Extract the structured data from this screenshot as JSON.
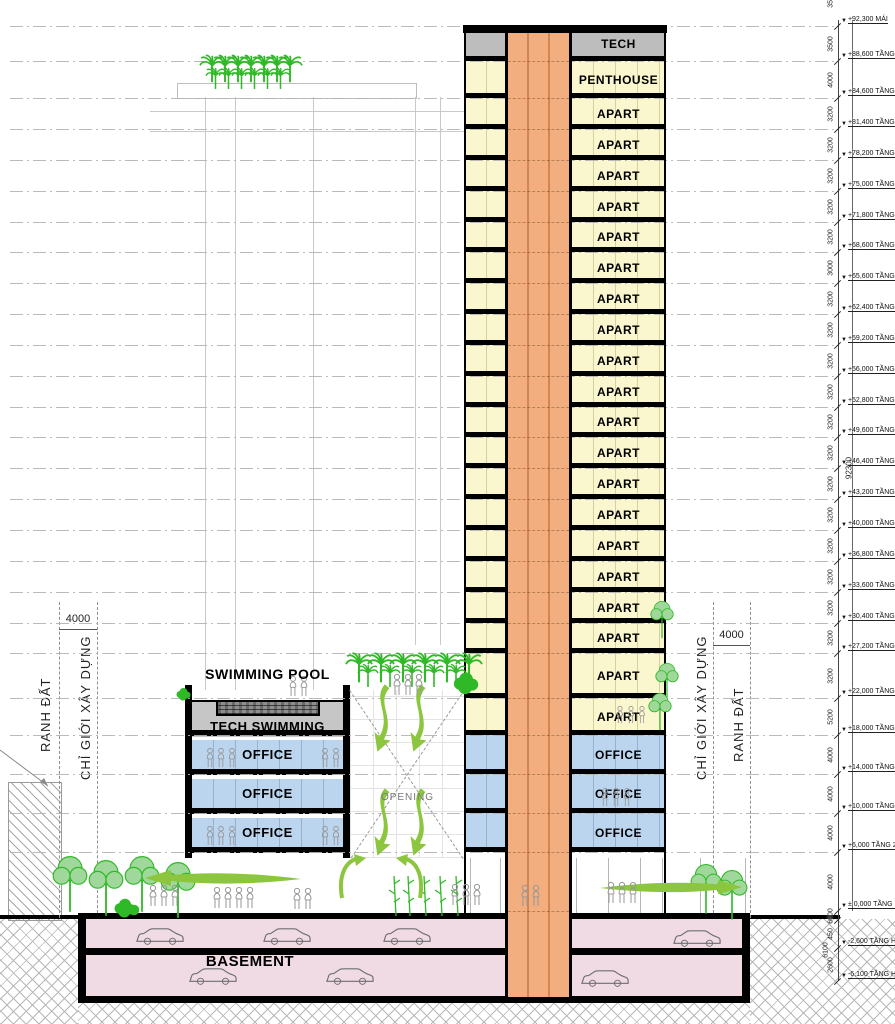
{
  "colors": {
    "slab": "#000000",
    "apart_fill": "#FAF7CE",
    "office_fill": "#BCD5EE",
    "core_fill": "#F2AE7E",
    "tech_gray": "#BDBDBD",
    "basement_fill": "#F0DBE4",
    "tree_green": "#2FB927",
    "swoosh_green": "#8CC63E"
  },
  "levels": {
    "ticks": [
      26,
      61,
      98,
      129,
      160,
      191,
      222,
      252,
      283,
      314,
      345,
      376,
      407,
      437,
      468,
      499,
      530,
      561,
      592,
      623,
      653,
      698,
      735,
      774,
      813,
      852,
      911,
      920,
      948,
      981
    ],
    "dims": [
      "3500",
      "4000",
      "3200",
      "3200",
      "3200",
      "3200",
      "3200",
      "3000",
      "3200",
      "3200",
      "3200",
      "3200",
      "3200",
      "3200",
      "3200",
      "3200",
      "3200",
      "3200",
      "3200",
      "3200",
      "3200",
      "5200",
      "4000",
      "4000",
      "4000",
      "4000",
      "6000",
      "450",
      "2600",
      "3500"
    ],
    "total_dim": "92300",
    "basement_total_dim": "6100",
    "markers": [
      {
        "label": "+92,300 MÁI",
        "tick": 0
      },
      {
        "label": "+88,600 TẦNG KỸ 1",
        "tick": 1
      },
      {
        "label": "+84,600 TẦNG 25",
        "tick": 2
      },
      {
        "label": "+81,400 TẦNG 24",
        "tick": 3
      },
      {
        "label": "+78,200 TẦNG 23",
        "tick": 4
      },
      {
        "label": "+75,000 TẦNG 22",
        "tick": 5
      },
      {
        "label": "+71,800 TẦNG 21",
        "tick": 6
      },
      {
        "label": "+68,600 TẦNG 20",
        "tick": 7
      },
      {
        "label": "+65,600 TẦNG 19",
        "tick": 8
      },
      {
        "label": "+62,400 TẦNG 18",
        "tick": 9
      },
      {
        "label": "+59,200 TẦNG 17",
        "tick": 10
      },
      {
        "label": "+56,000 TẦNG 16",
        "tick": 11
      },
      {
        "label": "+52,800 TẦNG 15",
        "tick": 12
      },
      {
        "label": "+49,600 TẦNG 14",
        "tick": 13
      },
      {
        "label": "+46,400 TẦNG 13",
        "tick": 14
      },
      {
        "label": "+43,200 TẦNG 12",
        "tick": 15
      },
      {
        "label": "+40,000 TẦNG 11",
        "tick": 16
      },
      {
        "label": "+36,800 TẦNG 10",
        "tick": 17
      },
      {
        "label": "+33,600 TẦNG 9",
        "tick": 18
      },
      {
        "label": "+30,400 TẦNG 8",
        "tick": 19
      },
      {
        "label": "+27,200 TẦNG 7",
        "tick": 20
      },
      {
        "label": "+22,000 TẦNG 6",
        "tick": 21
      },
      {
        "label": "+18,000 TẦNG 5",
        "tick": 22
      },
      {
        "label": "+14,000 TẦNG 4",
        "tick": 23
      },
      {
        "label": "+10,000 TẦNG 3",
        "tick": 24
      },
      {
        "label": "+6,000 TẦNG 2",
        "tick": 25
      },
      {
        "label": "± 0,000 TẦNG 1",
        "tick": 26
      },
      {
        "label": "-2,600 TẦNG HẦM 1",
        "tick": 28
      },
      {
        "label": "-6,100 TẦNG HẦM 2",
        "tick": 29
      }
    ]
  },
  "tower": {
    "floors": [
      {
        "label": "TECH",
        "type": "tech"
      },
      {
        "label": "PENTHOUSE",
        "type": "apart"
      },
      {
        "label": "APART",
        "type": "apart"
      },
      {
        "label": "APART",
        "type": "apart"
      },
      {
        "label": "APART",
        "type": "apart"
      },
      {
        "label": "APART",
        "type": "apart"
      },
      {
        "label": "APART",
        "type": "apart"
      },
      {
        "label": "APART",
        "type": "apart"
      },
      {
        "label": "APART",
        "type": "apart"
      },
      {
        "label": "APART",
        "type": "apart"
      },
      {
        "label": "APART",
        "type": "apart"
      },
      {
        "label": "APART",
        "type": "apart"
      },
      {
        "label": "APART",
        "type": "apart"
      },
      {
        "label": "APART",
        "type": "apart"
      },
      {
        "label": "APART",
        "type": "apart"
      },
      {
        "label": "APART",
        "type": "apart"
      },
      {
        "label": "APART",
        "type": "apart"
      },
      {
        "label": "APART",
        "type": "apart"
      },
      {
        "label": "APART",
        "type": "apart"
      },
      {
        "label": "APART",
        "type": "apart"
      },
      {
        "label": "APART",
        "type": "apart"
      },
      {
        "label": "APART",
        "type": "apart"
      },
      {
        "label": "OFFICE",
        "type": "office"
      },
      {
        "label": "OFFICE",
        "type": "office"
      },
      {
        "label": "OFFICE",
        "type": "office"
      },
      {
        "label": "",
        "type": "ground"
      }
    ]
  },
  "podium": {
    "pool_label": "SWIMMING POOL",
    "tech_swimming_label": "TECH SWIMMING",
    "office_labels": [
      "OFFICE",
      "OFFICE",
      "OFFICE"
    ],
    "opening_label": "OPENING",
    "basement_label": "BASEMENT"
  },
  "boundaries": {
    "left": [
      {
        "label": "RANH ĐẤT"
      },
      {
        "label": "CHỈ GIỚI XÂY DỰNG"
      }
    ],
    "right": [
      {
        "label": "CHỈ GIỚI XÂY DỰNG"
      },
      {
        "label": "RANH ĐẤT"
      }
    ],
    "setback_dim": "4000"
  }
}
